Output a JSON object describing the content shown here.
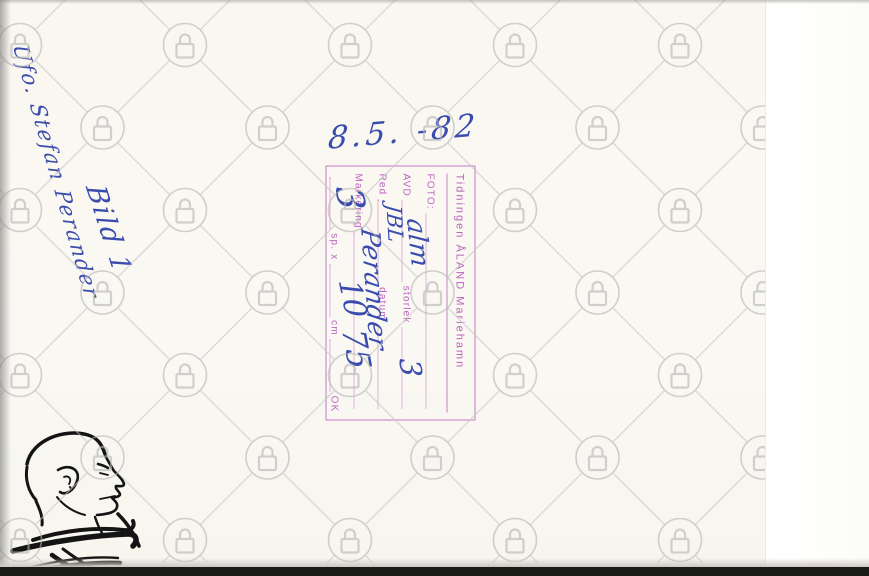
{
  "photo_back": {
    "handwritten_notes": {
      "name": "Ufo. Stefan Perander",
      "caption": "Bild 1",
      "date": "8.5. -82"
    },
    "stamp": {
      "header": "Tidningen ÅLAND Mariehamn",
      "labels": {
        "foto": "FOTO:",
        "avd": "AVD",
        "storlek": "storlek",
        "red": "Red",
        "datum": "datum",
        "markering": "Markering",
        "sp": "sp. x",
        "cm": "cm",
        "ok": "OK"
      },
      "entries": {
        "avd": "alm",
        "red": "JBL",
        "name": "Perander",
        "storlek": "3",
        "sp": "3",
        "cm": "10",
        "extra": "75"
      }
    },
    "colors": {
      "ink_blue": "#3a4cae",
      "stamp_purple": "#bb64be",
      "watermark_gray": "#b5b5b5",
      "edge_black": "#191918"
    },
    "watermark": {
      "icon": "padlock-icon"
    },
    "portrait": {
      "description": "black line drawing, profile of bald man facing right"
    }
  }
}
